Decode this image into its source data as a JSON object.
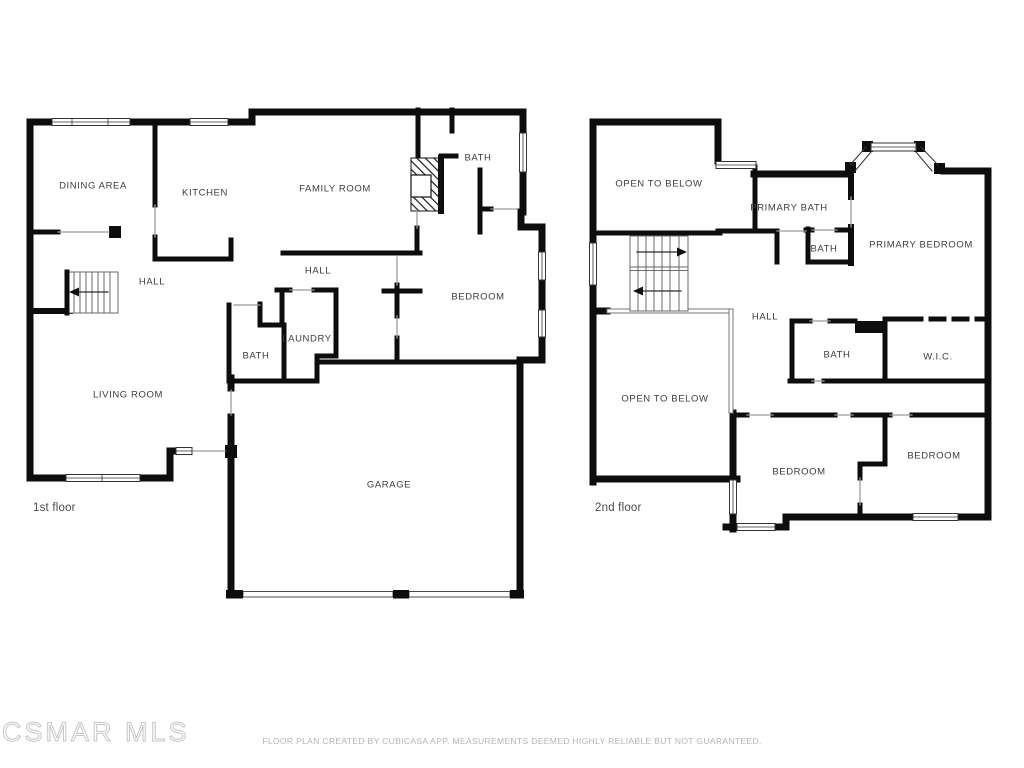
{
  "watermark": "CSMAR MLS",
  "footer": "FLOOR PLAN CREATED BY CUBICASA APP. MEASUREMENTS DEEMED HIGHLY RELIABLE BUT NOT GUARANTEED.",
  "colors": {
    "wall": "#0d0d0d",
    "room_label": "#3d3d3d",
    "footer_text": "#b5b5b5",
    "watermark_outline": "#c6c6c6"
  },
  "floors": [
    {
      "title": "1st floor",
      "rooms": [
        {
          "label": "DINING AREA",
          "x": 93,
          "y": 186
        },
        {
          "label": "KITCHEN",
          "x": 205,
          "y": 193
        },
        {
          "label": "FAMILY ROOM",
          "x": 335,
          "y": 189
        },
        {
          "label": "BATH",
          "x": 478,
          "y": 158
        },
        {
          "label": "HALL",
          "x": 152,
          "y": 282
        },
        {
          "label": "HALL",
          "x": 318,
          "y": 271
        },
        {
          "label": "BEDROOM",
          "x": 478,
          "y": 297
        },
        {
          "label": "LAUNDRY",
          "x": 307,
          "y": 339
        },
        {
          "label": "BATH",
          "x": 256,
          "y": 356
        },
        {
          "label": "LIVING ROOM",
          "x": 128,
          "y": 395
        },
        {
          "label": "GARAGE",
          "x": 389,
          "y": 485
        }
      ]
    },
    {
      "title": "2nd floor",
      "rooms": [
        {
          "label": "OPEN TO BELOW",
          "x": 659,
          "y": 184
        },
        {
          "label": "PRIMARY BATH",
          "x": 789,
          "y": 208
        },
        {
          "label": "BATH",
          "x": 824,
          "y": 249
        },
        {
          "label": "PRIMARY BEDROOM",
          "x": 921,
          "y": 245
        },
        {
          "label": "HALL",
          "x": 765,
          "y": 317
        },
        {
          "label": "BATH",
          "x": 837,
          "y": 355
        },
        {
          "label": "W.I.C.",
          "x": 938,
          "y": 357
        },
        {
          "label": "OPEN TO BELOW",
          "x": 665,
          "y": 399
        },
        {
          "label": "BEDROOM",
          "x": 799,
          "y": 472
        },
        {
          "label": "BEDROOM",
          "x": 934,
          "y": 456
        }
      ]
    }
  ]
}
